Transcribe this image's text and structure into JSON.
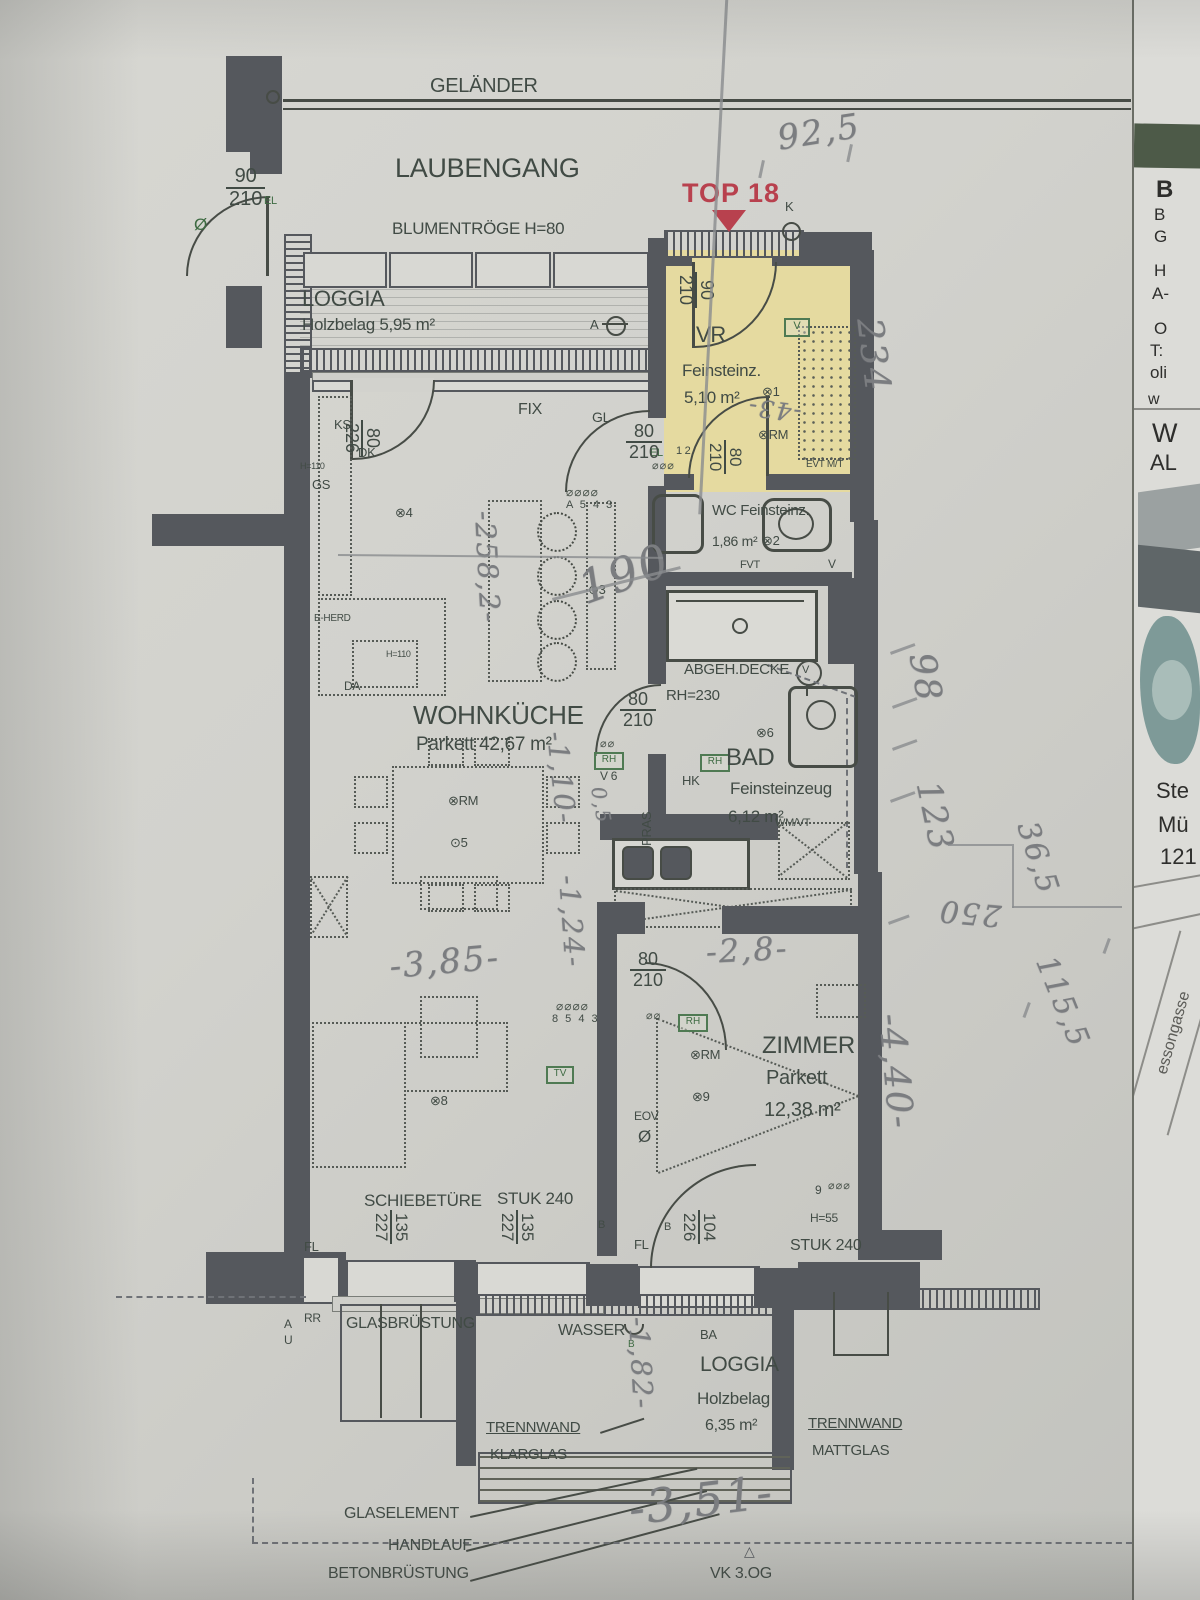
{
  "top": {
    "gelaender": "GELÄNDER",
    "laubengang": "LAUBENGANG",
    "blumentroege": "BLUMENTRÖGE H=80",
    "top18": "TOP 18",
    "k": "K",
    "door": {
      "num": "90",
      "den": "210",
      "el": "EL",
      "oe": "Ø"
    }
  },
  "loggia_top": {
    "name": "LOGGIA",
    "floor": "Holzbelag 5,95 m²",
    "a": "A"
  },
  "vr": {
    "name": "VR",
    "floor": "Feinsteinz.",
    "area": "5,10 m²",
    "door": {
      "num": "90",
      "den": "210"
    },
    "door2": {
      "num": "80",
      "den": "210"
    },
    "v": "V",
    "x1": "⊗1",
    "rm": "⊗RM",
    "evt": "EVT M/T",
    "el": "EL",
    "onetwo": "1 2"
  },
  "kitchen": {
    "name": "WOHNKÜCHE",
    "floor": "Parkett 42,67 m²",
    "fix": "FIX",
    "gl": "GL",
    "door_gl": {
      "num": "80",
      "den": "210"
    },
    "door_loggia": {
      "num": "80",
      "den": "226"
    },
    "ks": "KS",
    "dk": "DK",
    "gs": "GS",
    "h110": "H=110",
    "h110b": "H=110",
    "eherd": "E-HERD",
    "da": "DA",
    "x4": "⊗4",
    "x3": "⊙3",
    "rm": "⊗RM",
    "x5": "⊙5",
    "sockets": "A 5 4 3"
  },
  "wc": {
    "title": "WC Feinsteinz.",
    "area": "1,86 m²",
    "x2": "⊗2",
    "fvt": "FVT",
    "v": "V"
  },
  "bath": {
    "abgeh": "ABGEH.DECKE",
    "rh": "RH=230",
    "name": "BAD",
    "floor": "Feinsteinzeug",
    "area": "6,12 m²",
    "x6": "⊗6",
    "wm": "WM/VT",
    "hk": "HK",
    "door": {
      "num": "80",
      "den": "210"
    },
    "rh_box": "RH",
    "rh_box2": "RH",
    "v6": "V 6",
    "pras": "PRAS",
    "vcirc": "V"
  },
  "zimmer": {
    "name": "ZIMMER",
    "floor": "Parkett",
    "area": "12,38 m²",
    "rm": "⊗RM",
    "x9": "⊗9",
    "eov": "EOV",
    "oe": "Ø",
    "door": {
      "num": "80",
      "den": "210"
    },
    "win": {
      "num": "104",
      "den": "226"
    },
    "nine": "9",
    "h55": "H=55",
    "stuk": "STUK 240",
    "rh_box": "RH",
    "tv": "TV"
  },
  "living": {
    "schiebetuere": "SCHIEBETÜRE",
    "stuk": "STUK 240",
    "win1": {
      "num": "135",
      "den": "227"
    },
    "win2": {
      "num": "135",
      "den": "227"
    },
    "fl": "FL",
    "fl2": "FL",
    "b": "B",
    "b2": "B",
    "x8": "⊗8",
    "sockets": "8 5 4 3"
  },
  "loggia_bottom": {
    "rr": "RR",
    "a": "A",
    "u": "U",
    "glasbruestung": "GLASBRÜSTUNG",
    "wasser": "WASSER",
    "b": "B",
    "ba": "BA",
    "name": "LOGGIA",
    "floor": "Holzbelag",
    "area": "6,35 m²",
    "tw1": "TRENNWAND",
    "tw1b": "KLARGLAS",
    "tw2": "TRENNWAND",
    "tw2b": "MATTGLAS"
  },
  "bottom": {
    "glaselement": "GLASELEMENT",
    "handlauf": "HANDLAUF",
    "betonbruestung": "BETONBRÜSTUNG",
    "vk": "VK 3.OG",
    "marker": "△"
  },
  "hw": {
    "n925": "92,5",
    "n234": "234",
    "n43": "-43-",
    "n98": "98",
    "n123": "123",
    "n250": "250",
    "n365": "36,5",
    "n1155": "115,5",
    "n440": "-4,40-",
    "n28": "-2,8-",
    "n385": "-3,85-",
    "n2582": "-258,2-",
    "n190": "190",
    "n110": "-1,10-",
    "n05": "0,5",
    "n124": "-1,24-",
    "n182": "-1,82-",
    "n351": "-3,51-"
  },
  "icons": {
    "sockets4": "⌀⌀⌀⌀",
    "sockets3": "⌀⌀⌀",
    "sockets2": "⌀⌀"
  },
  "side": {
    "b1": "B",
    "b2": "B",
    "g": "G",
    "h": "H",
    "a": "A-",
    "o": "O",
    "t": "T:",
    "oli": "oli",
    "w": "w",
    "w2": "W",
    "al": "AL",
    "ste": "Ste",
    "mue": "Mü",
    "n121": "121",
    "gasse": "essongasse"
  }
}
